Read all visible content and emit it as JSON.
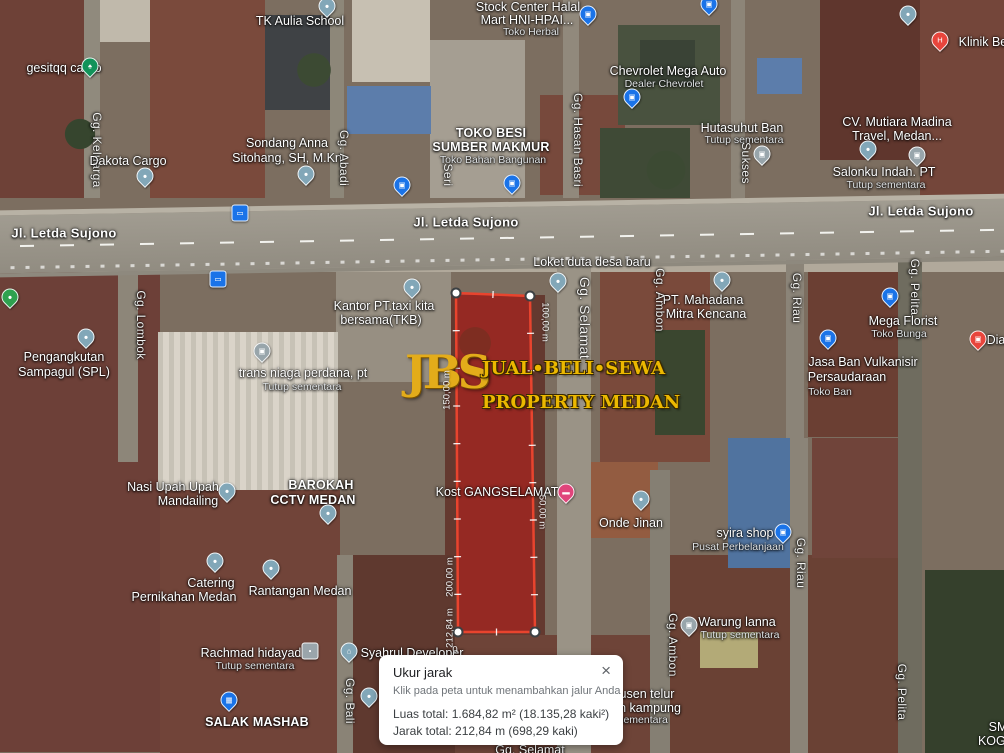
{
  "colors": {
    "polygon_fill": "rgba(190,30,25,0.55)",
    "polygon_stroke": "#e8442e",
    "watermark_gold": "#e3ac1a",
    "pin_blue": "#1a73e8",
    "road_label_white": "#ffffff",
    "dialog_bg": "#ffffff"
  },
  "watermark": {
    "initials": "JBS",
    "line1": "JUAL•BELI•SEWA",
    "line2": "PROPERTY MEDAN"
  },
  "dialog": {
    "title": "Ukur jarak",
    "subtitle": "Klik pada peta untuk menambahkan jalur Anda",
    "area_line": "Luas total: 1.684,82 m² (18.135,28 kaki²)",
    "distance_line": "Jarak total: 212,84 m (698,29 kaki)",
    "close": "×"
  },
  "polygon": {
    "vertices": [
      [
        456,
        293
      ],
      [
        530,
        296
      ],
      [
        535,
        632
      ],
      [
        458,
        632
      ]
    ],
    "fill": "rgba(190,30,25,0.55)",
    "stroke": "#e8442e",
    "stroke_width": 2.5,
    "handle_fill": "#ffffff",
    "handle_stroke": "#3c4043",
    "tick_spacing": 38
  },
  "map": {
    "pin_styles": {
      "shop": {
        "color": "#1a73e8",
        "glyph": "▣"
      },
      "shopgray": {
        "color": "#98a5ab",
        "glyph": "▣"
      },
      "poi": {
        "color": "#82a7b8",
        "glyph": "●"
      },
      "tree": {
        "color": "#12935a",
        "glyph": "♠"
      },
      "health": {
        "color": "#e8453c",
        "glyph": "H"
      },
      "bus": {
        "color": "#1a73e8",
        "glyph": "▭",
        "shape": "square"
      },
      "food": {
        "color": "#2fa14f",
        "glyph": "●"
      },
      "reddot": {
        "color": "#e8453c",
        "glyph": "▣"
      },
      "lodging": {
        "color": "#e0457b",
        "glyph": "▬"
      },
      "lock": {
        "color": "#9aa5ab",
        "glyph": "▪",
        "shape": "square"
      },
      "museum": {
        "color": "#82a7b8",
        "glyph": "⌂"
      },
      "cart": {
        "color": "#1a73e8",
        "glyph": "▦"
      }
    },
    "labels": [
      {
        "text": "TK Aulia School",
        "x": 300,
        "y": 21,
        "cls": "place"
      },
      {
        "text": "gesitqq cargo",
        "x": 64,
        "y": 68,
        "cls": "place"
      },
      {
        "text": "Gg. Keluarga",
        "x": 97,
        "y": 150,
        "cls": "streetv",
        "rot": 90
      },
      {
        "text": "Dakota Cargo",
        "x": 128,
        "y": 161,
        "cls": "place"
      },
      {
        "text": "Sondang Anna",
        "x": 287,
        "y": 143,
        "cls": "place"
      },
      {
        "text": "Sitohang, SH, M.Kn",
        "x": 287,
        "y": 158,
        "cls": "place"
      },
      {
        "text": "Gg. Abadi",
        "x": 344,
        "y": 158,
        "cls": "streetv",
        "rot": 90
      },
      {
        "text": "TOKO BESI",
        "x": 491,
        "y": 133,
        "cls": "placecaps"
      },
      {
        "text": "SUMBER MAKMUR",
        "x": 491,
        "y": 147,
        "cls": "placecaps"
      },
      {
        "text": "Toko Bahan Bangunan",
        "x": 493,
        "y": 160,
        "cls": "sub"
      },
      {
        "text": "Seri",
        "x": 448,
        "y": 175,
        "cls": "streetv",
        "rot": 90
      },
      {
        "text": "Stock Center Halal",
        "x": 528,
        "y": 7,
        "cls": "place"
      },
      {
        "text": "Mart HNI-HPAI...",
        "x": 527,
        "y": 20,
        "cls": "place"
      },
      {
        "text": "Toko Herbal",
        "x": 531,
        "y": 32,
        "cls": "sub"
      },
      {
        "text": "Chevrolet Mega Auto",
        "x": 668,
        "y": 71,
        "cls": "place"
      },
      {
        "text": "Dealer Chevrolet",
        "x": 664,
        "y": 84,
        "cls": "sub"
      },
      {
        "text": "Gg. Hasan Basri",
        "x": 578,
        "y": 140,
        "cls": "streetv",
        "rot": 90
      },
      {
        "text": "Hutasuhut Ban",
        "x": 742,
        "y": 128,
        "cls": "place"
      },
      {
        "text": "Tutup sementara",
        "x": 744,
        "y": 140,
        "cls": "sub"
      },
      {
        "text": "Sukses",
        "x": 746,
        "y": 163,
        "cls": "streetv",
        "rot": 90
      },
      {
        "text": "CV. Mutiara Madina",
        "x": 897,
        "y": 122,
        "cls": "place"
      },
      {
        "text": "Travel, Medan...",
        "x": 897,
        "y": 136,
        "cls": "place"
      },
      {
        "text": "Klinik Ber",
        "x": 985,
        "y": 42,
        "cls": "place"
      },
      {
        "text": "Salonku Indah. PT",
        "x": 884,
        "y": 172,
        "cls": "place"
      },
      {
        "text": "Tutup sementara",
        "x": 886,
        "y": 185,
        "cls": "sub"
      },
      {
        "text": "Jl. Letda Sujono",
        "x": 64,
        "y": 233,
        "cls": "road"
      },
      {
        "text": "Jl. Letda Sujono",
        "x": 466,
        "y": 222,
        "cls": "road"
      },
      {
        "text": "Jl. Letda Sujono",
        "x": 921,
        "y": 211,
        "cls": "road"
      },
      {
        "text": "Loket duta desa baru",
        "x": 592,
        "y": 262,
        "cls": "place"
      },
      {
        "text": "Kantor PT.taxi kita",
        "x": 384,
        "y": 306,
        "cls": "place"
      },
      {
        "text": "bersama(TKB)",
        "x": 381,
        "y": 320,
        "cls": "place"
      },
      {
        "text": "Gg. Lombok",
        "x": 141,
        "y": 325,
        "cls": "streetv",
        "rot": 90
      },
      {
        "text": "Pengangkutan",
        "x": 64,
        "y": 357,
        "cls": "place"
      },
      {
        "text": "Sampagul (SPL)",
        "x": 64,
        "y": 372,
        "cls": "place"
      },
      {
        "text": "trans niaga perdana, pt",
        "x": 303,
        "y": 373,
        "cls": "place"
      },
      {
        "text": "Tutup sementara",
        "x": 302,
        "y": 387,
        "cls": "sub"
      },
      {
        "text": "Gg. Selamat",
        "x": 585,
        "y": 318,
        "cls": "streetv",
        "rot": 90,
        "fs": 14
      },
      {
        "text": "PT. Mahadana",
        "x": 703,
        "y": 300,
        "cls": "place"
      },
      {
        "text": "Mitra Kencana",
        "x": 706,
        "y": 314,
        "cls": "place"
      },
      {
        "text": "Gg. Ambon",
        "x": 660,
        "y": 300,
        "cls": "streetv",
        "rot": 90
      },
      {
        "text": "Gg. Riau",
        "x": 797,
        "y": 298,
        "cls": "streetv",
        "rot": 90
      },
      {
        "text": "Gg. Pelita",
        "x": 915,
        "y": 287,
        "cls": "streetv",
        "rot": 90
      },
      {
        "text": "Mega Florist",
        "x": 903,
        "y": 321,
        "cls": "place"
      },
      {
        "text": "Toko Bunga",
        "x": 899,
        "y": 334,
        "cls": "sub"
      },
      {
        "text": "Jasa Ban Vulkanisir",
        "x": 863,
        "y": 362,
        "cls": "place"
      },
      {
        "text": "Persaudaraan",
        "x": 847,
        "y": 377,
        "cls": "place"
      },
      {
        "text": "Toko Ban",
        "x": 830,
        "y": 392,
        "cls": "sub"
      },
      {
        "text": "Dia",
        "x": 996,
        "y": 340,
        "cls": "place"
      },
      {
        "text": "Nasi Upah Upah",
        "x": 173,
        "y": 487,
        "cls": "place"
      },
      {
        "text": "Mandailing",
        "x": 188,
        "y": 501,
        "cls": "place"
      },
      {
        "text": "BAROKAH",
        "x": 321,
        "y": 485,
        "cls": "placecaps"
      },
      {
        "text": "CCTV MEDAN",
        "x": 313,
        "y": 500,
        "cls": "placecaps"
      },
      {
        "text": "Kost GANGSELAMAT",
        "x": 497,
        "y": 492,
        "cls": "place"
      },
      {
        "text": "Onde Jinan",
        "x": 631,
        "y": 523,
        "cls": "place"
      },
      {
        "text": "syira shop",
        "x": 745,
        "y": 533,
        "cls": "place"
      },
      {
        "text": "Pusat Perbelanjaan",
        "x": 738,
        "y": 547,
        "cls": "sub"
      },
      {
        "text": "Gg. Riau",
        "x": 801,
        "y": 563,
        "cls": "streetv",
        "rot": 90
      },
      {
        "text": "Catering",
        "x": 211,
        "y": 583,
        "cls": "place"
      },
      {
        "text": "Pernikahan Medan",
        "x": 184,
        "y": 597,
        "cls": "place"
      },
      {
        "text": "Rantangan Medan",
        "x": 300,
        "y": 591,
        "cls": "place"
      },
      {
        "text": "Rachmad hidayad",
        "x": 251,
        "y": 653,
        "cls": "place"
      },
      {
        "text": "Tutup sementara",
        "x": 255,
        "y": 666,
        "cls": "sub"
      },
      {
        "text": "Syahrul Developer",
        "x": 412,
        "y": 653,
        "cls": "place"
      },
      {
        "text": "Gg. Bali",
        "x": 350,
        "y": 701,
        "cls": "streetv",
        "rot": 90
      },
      {
        "text": "SALAK MASHAB",
        "x": 257,
        "y": 722,
        "cls": "placecaps"
      },
      {
        "text": "Warung lanna",
        "x": 737,
        "y": 622,
        "cls": "place"
      },
      {
        "text": "Tutup sementara",
        "x": 740,
        "y": 635,
        "cls": "sub"
      },
      {
        "text": "Gg. Ambon",
        "x": 673,
        "y": 645,
        "cls": "streetv",
        "rot": 90
      },
      {
        "text": "usen telur",
        "x": 647,
        "y": 694,
        "cls": "place"
      },
      {
        "text": "n kampung",
        "x": 650,
        "y": 708,
        "cls": "place"
      },
      {
        "text": "sementara",
        "x": 643,
        "y": 720,
        "cls": "sub"
      },
      {
        "text": "Gg. Pelita",
        "x": 902,
        "y": 692,
        "cls": "streetv",
        "rot": 90
      },
      {
        "text": "SM",
        "x": 998,
        "y": 727,
        "cls": "place"
      },
      {
        "text": "KOGA",
        "x": 996,
        "y": 741,
        "cls": "place"
      },
      {
        "text": "Gg. Selamat",
        "x": 530,
        "y": 750,
        "cls": "place"
      },
      {
        "text": "100,00 m",
        "x": 545,
        "y": 322,
        "cls": "measure",
        "rot": 90
      },
      {
        "text": "50,00 m",
        "x": 542,
        "y": 512,
        "cls": "measure",
        "rot": 90
      },
      {
        "text": "150,00 m",
        "x": 447,
        "y": 390,
        "cls": "measure",
        "rot": -90
      },
      {
        "text": "200,00 m",
        "x": 450,
        "y": 577,
        "cls": "measure",
        "rot": -90
      },
      {
        "text": "212,84 m",
        "x": 450,
        "y": 628,
        "cls": "measure",
        "rot": -90
      },
      {
        "text": "0",
        "x": 455,
        "y": 650,
        "cls": "measure"
      }
    ],
    "pins": [
      {
        "type": "poi",
        "x": 327,
        "y": 6
      },
      {
        "type": "tree",
        "x": 90,
        "y": 66
      },
      {
        "type": "poi",
        "x": 145,
        "y": 176
      },
      {
        "type": "poi",
        "x": 306,
        "y": 174
      },
      {
        "type": "shop",
        "x": 402,
        "y": 185
      },
      {
        "type": "shop",
        "x": 512,
        "y": 183
      },
      {
        "type": "shop",
        "x": 588,
        "y": 14
      },
      {
        "type": "shop",
        "x": 709,
        "y": 4
      },
      {
        "type": "shop",
        "x": 632,
        "y": 97
      },
      {
        "type": "shopgray",
        "x": 762,
        "y": 154
      },
      {
        "type": "poi",
        "x": 868,
        "y": 149
      },
      {
        "type": "shopgray",
        "x": 917,
        "y": 155
      },
      {
        "type": "poi",
        "x": 908,
        "y": 14
      },
      {
        "type": "health",
        "x": 940,
        "y": 40
      },
      {
        "type": "bus",
        "x": 240,
        "y": 213
      },
      {
        "type": "bus",
        "x": 218,
        "y": 279
      },
      {
        "type": "poi",
        "x": 558,
        "y": 281
      },
      {
        "type": "poi",
        "x": 412,
        "y": 287
      },
      {
        "type": "food",
        "x": 10,
        "y": 297
      },
      {
        "type": "poi",
        "x": 86,
        "y": 337
      },
      {
        "type": "shopgray",
        "x": 262,
        "y": 351
      },
      {
        "type": "poi",
        "x": 722,
        "y": 280
      },
      {
        "type": "shop",
        "x": 890,
        "y": 296
      },
      {
        "type": "shop",
        "x": 828,
        "y": 338
      },
      {
        "type": "reddot",
        "x": 978,
        "y": 339
      },
      {
        "type": "poi",
        "x": 227,
        "y": 491
      },
      {
        "type": "poi",
        "x": 328,
        "y": 513
      },
      {
        "type": "lodging",
        "x": 566,
        "y": 492
      },
      {
        "type": "poi",
        "x": 641,
        "y": 499
      },
      {
        "type": "shop",
        "x": 783,
        "y": 532
      },
      {
        "type": "poi",
        "x": 215,
        "y": 561
      },
      {
        "type": "poi",
        "x": 271,
        "y": 568
      },
      {
        "type": "lock",
        "x": 310,
        "y": 651
      },
      {
        "type": "museum",
        "x": 349,
        "y": 651
      },
      {
        "type": "poi",
        "x": 369,
        "y": 696
      },
      {
        "type": "cart",
        "x": 229,
        "y": 700
      },
      {
        "type": "shopgray",
        "x": 689,
        "y": 625
      }
    ]
  }
}
